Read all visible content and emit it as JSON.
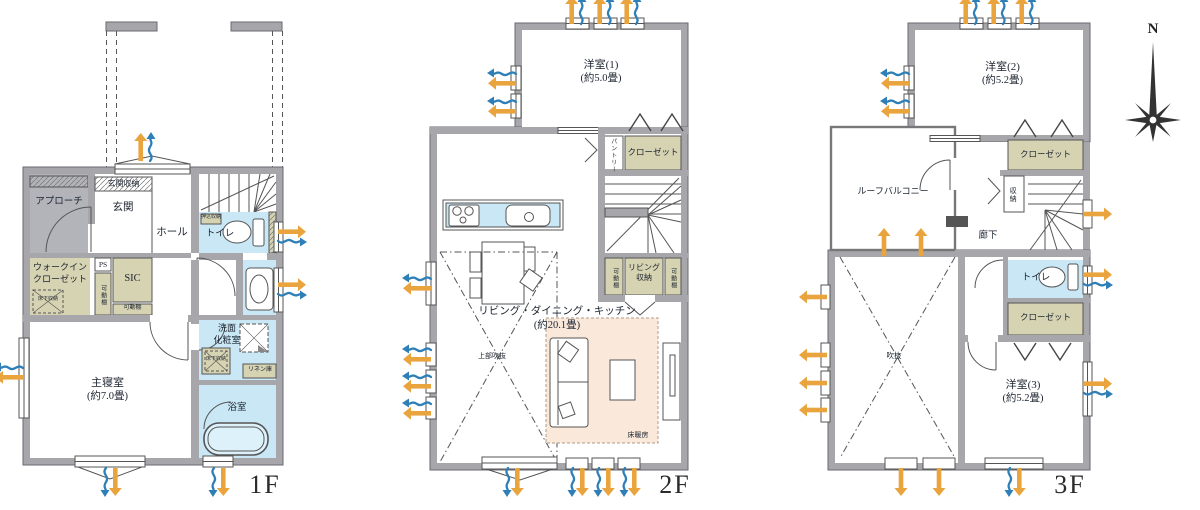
{
  "title": "3-story house floor plan",
  "compass": {
    "north_label": "N"
  },
  "colors": {
    "wall": "#a6a6ab",
    "water_room": "#c9e7f5",
    "storage": "#d6d3b2",
    "floor_heating_area": "#fae9da",
    "approach": "#b2b4ba",
    "vent_blue": "#2e7fb8",
    "vent_orange": "#eaa43e",
    "text": "#1c2430"
  },
  "floors": [
    {
      "id": "1f",
      "label": "1F",
      "rooms": {
        "approach": "アプローチ",
        "entrance_storage": "玄関収納",
        "entrance": "玄関",
        "hall": "ホール",
        "built_in_storage": "押込収納",
        "toilet": "トイレ",
        "walk_in_closet_line1": "ウォークイン",
        "walk_in_closet_line2": "クローゼット",
        "underfloor_storage_wic": "床下収納",
        "pipe_space": "PS",
        "movable_shelf_vertical": "可動棚",
        "shoes_in_closet": "SIC",
        "movable_shelf_bottom": "可動棚",
        "master_bedroom": "主寝室",
        "master_bedroom_size": "(約7.0畳)",
        "washroom_line1": "洗面",
        "washroom_line2": "化粧室",
        "underfloor_storage_wash": "床下収納",
        "linen_storage": "リネン庫",
        "bathroom": "浴室"
      }
    },
    {
      "id": "2f",
      "label": "2F",
      "rooms": {
        "western_room_1": "洋室(1)",
        "western_room_1_size": "(約5.0畳)",
        "pantry": "パントリー",
        "closet": "クローゼット",
        "living_storage_line1": "リビング",
        "living_storage_line2": "収納",
        "movable_shelf_left": "可動棚",
        "movable_shelf_right": "可動棚",
        "ldk": "リビング・ダイニング・キッチン",
        "ldk_size": "(約20.1畳)",
        "open_to_above": "上部吹抜",
        "floor_heating": "床暖房"
      }
    },
    {
      "id": "3f",
      "label": "3F",
      "rooms": {
        "western_room_2": "洋室(2)",
        "western_room_2_size": "(約5.2畳)",
        "roof_balcony": "ルーフバルコニー",
        "closet_upper": "クローゼット",
        "storage": "収納",
        "corridor": "廊下",
        "toilet": "トイレ",
        "closet_lower": "クローゼット",
        "void": "吹抜",
        "western_room_3": "洋室(3)",
        "western_room_3_size": "(約5.2畳)"
      }
    }
  ]
}
